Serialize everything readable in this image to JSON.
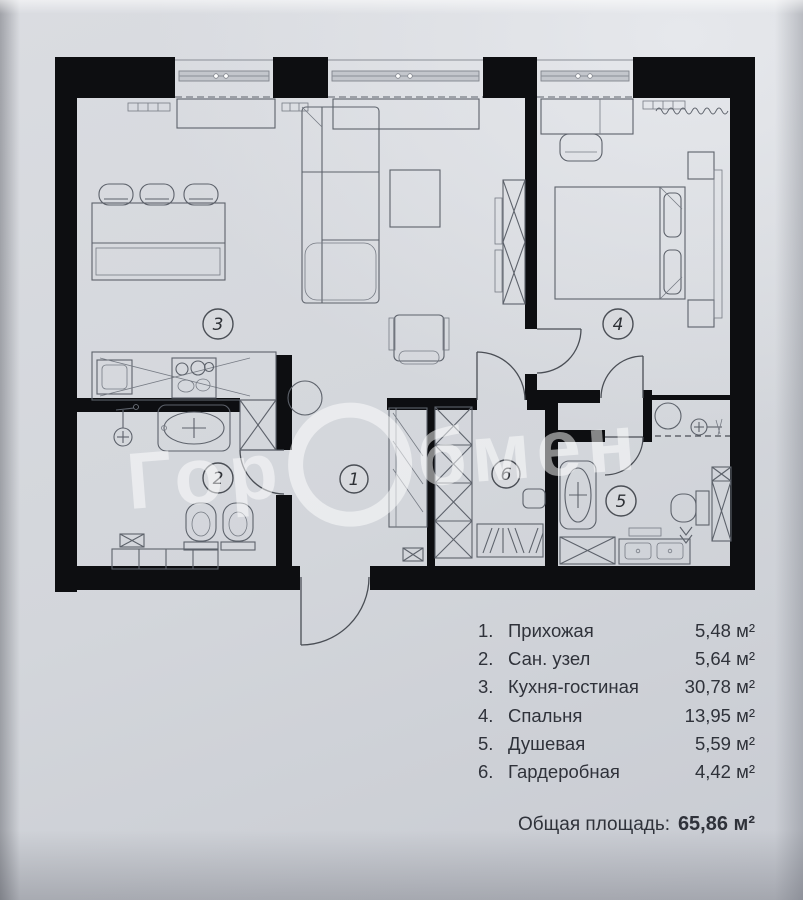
{
  "watermark": {
    "left": "Гор",
    "ring": "О",
    "right": "бмен"
  },
  "plan": {
    "numbers": [
      "1",
      "2",
      "3",
      "4",
      "5",
      "6"
    ]
  },
  "legend": {
    "items": [
      {
        "number": "1.",
        "label": "Прихожая",
        "area": "5,48 м²"
      },
      {
        "number": "2.",
        "label": "Сан. узел",
        "area": "5,64 м²"
      },
      {
        "number": "3.",
        "label": "Кухня-гостиная",
        "area": "30,78 м²"
      },
      {
        "number": "4.",
        "label": "Спальня",
        "area": "13,95 м²"
      },
      {
        "number": "5.",
        "label": "Душевая",
        "area": "5,59 м²"
      },
      {
        "number": "6.",
        "label": "Гардеробная",
        "area": "4,42 м²"
      }
    ],
    "total_label": "Общая площадь:",
    "total_value": "65,86 м²"
  },
  "colors": {
    "wall": "#0d0e11",
    "paper": "#d6d9de",
    "line": "#5d626b"
  }
}
